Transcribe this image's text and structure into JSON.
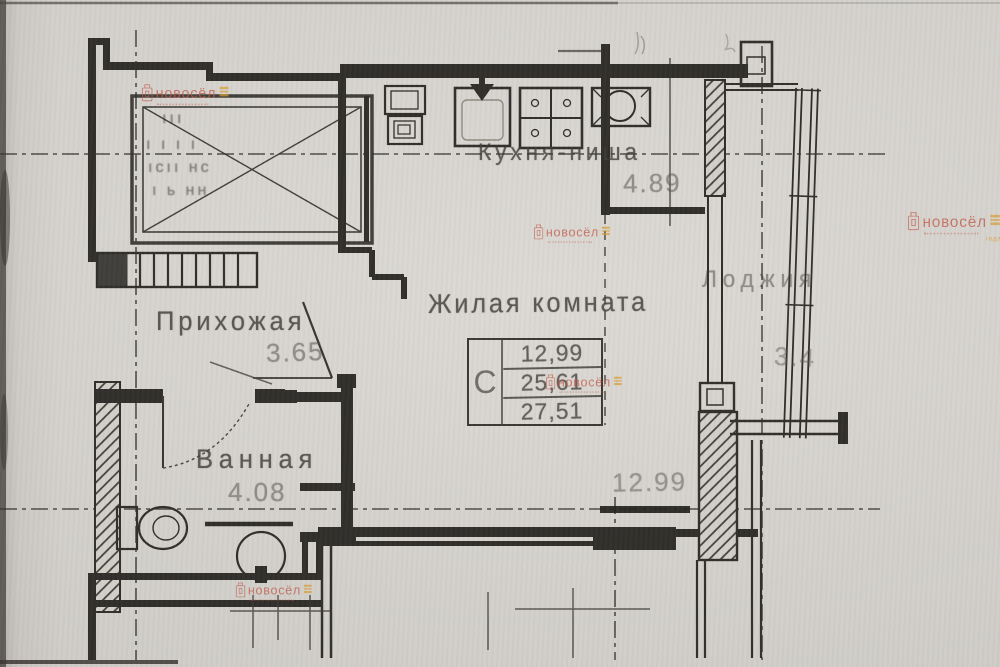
{
  "plan": {
    "rooms": {
      "hallway": {
        "label": "Прихожая",
        "dim": "3.65"
      },
      "bathroom": {
        "label": "Ванная",
        "dim": "4.08"
      },
      "living": {
        "label": "Жилая комната"
      },
      "kitchen": {
        "label": "Кухня-ниша",
        "dim": "4.89"
      },
      "loggia": {
        "label": "Лоджия",
        "dim": "3.4"
      }
    },
    "dims": {
      "bottom_right": "12.99"
    },
    "area_table": {
      "col": "С",
      "row1": "12,99",
      "row2": "25,61",
      "row3": "27,51"
    },
    "stairwell_marks": {
      "r1": "ııı",
      "r2": "ı ı   ı ı",
      "r3": "ıcıı нc",
      "r4": "ı ь нн"
    }
  },
  "watermark": {
    "brand": "новосёл",
    "caption": "года"
  }
}
